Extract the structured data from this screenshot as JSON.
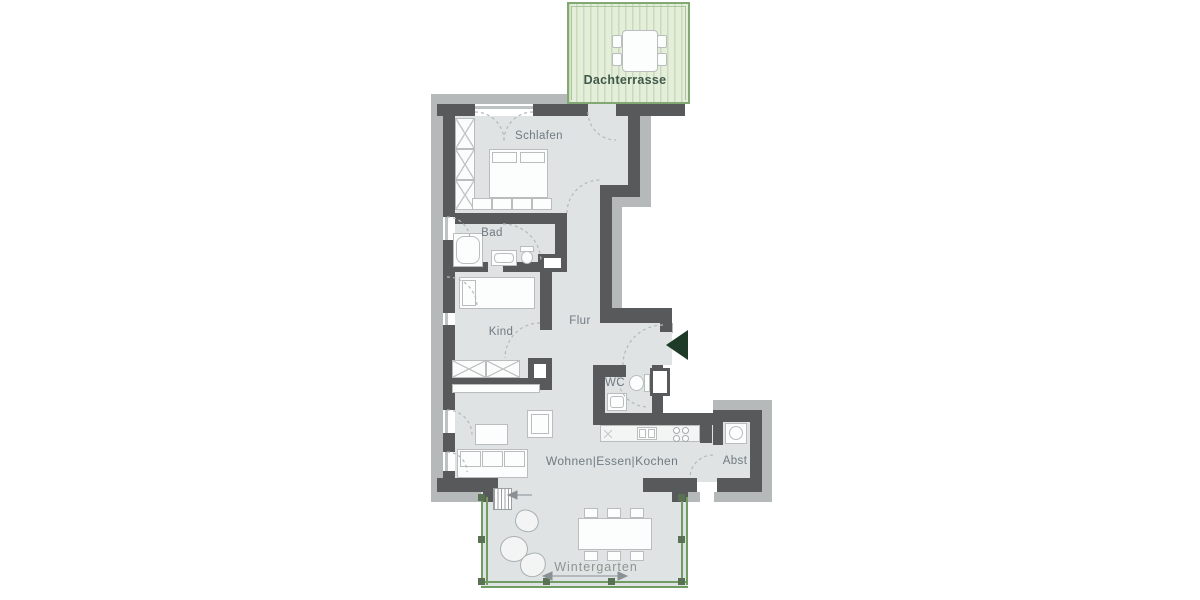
{
  "plan_type": "apartment floor plan",
  "rooms": {
    "dachterrasse": {
      "label": "Dachterrasse"
    },
    "schlafen": {
      "label": "Schlafen"
    },
    "bad": {
      "label": "Bad"
    },
    "kind": {
      "label": "Kind"
    },
    "flur": {
      "label": "Flur"
    },
    "wc": {
      "label": "WC"
    },
    "wohnen_essen_kochen": {
      "label": "Wohnen|Essen|Kochen"
    },
    "abst": {
      "label": "Abst"
    },
    "wintergarten": {
      "label": "Wintergarten"
    }
  },
  "icons": {
    "entrance-arrow": "solid dark-green triangle pointing left at apartment entrance",
    "stairs-direction-arrow": "small gray arrow pointing left at wintergarten steps",
    "span-arrow": "double-headed gray arrow across wintergarten width"
  },
  "colors": {
    "wall": "#58595b",
    "exterior_band": "#b5b9ba",
    "floor": "#dfe3e4",
    "furniture_line": "#b9bdbe",
    "terrace_fill": "#e4eeda",
    "terrace_stripe": "#c8dbba",
    "terrace_border": "#82a974",
    "wintergarten_frame": "#719d63",
    "entrance_arrow": "#1e3b27",
    "room_label": "#6f7a80",
    "terrace_label": "#40594a",
    "wintergarten_label": "#8c968f",
    "door_swing": "#b3b9bb"
  }
}
